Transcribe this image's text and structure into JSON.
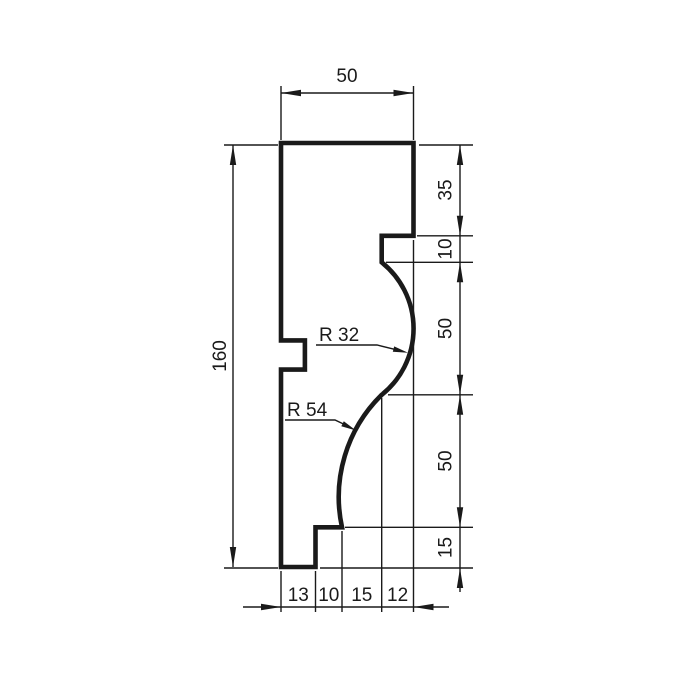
{
  "drawing": {
    "type": "technical-drawing",
    "description": "Dimensioned cross-section profile of a decorative molding",
    "background_color": "#ffffff",
    "line_color": "#1a1a1a",
    "units_scale_px_per_unit": 2.65,
    "profile": {
      "width": 50,
      "height": 160
    },
    "dims": {
      "top_width": {
        "label": "50",
        "value": 50
      },
      "left_height": {
        "label": "160",
        "value": 160
      },
      "right_segments": [
        {
          "label": "35",
          "value": 35
        },
        {
          "label": "10",
          "value": 10
        },
        {
          "label": "50",
          "value": 50
        },
        {
          "label": "50",
          "value": 50
        },
        {
          "label": "15",
          "value": 15
        }
      ],
      "bottom_segments": [
        {
          "label": "13",
          "value": 13
        },
        {
          "label": "10",
          "value": 10
        },
        {
          "label": "15",
          "value": 15
        },
        {
          "label": "12",
          "value": 12
        }
      ],
      "radii": [
        {
          "label": "R 32",
          "value": 32
        },
        {
          "label": "R 54",
          "value": 54
        }
      ]
    }
  }
}
